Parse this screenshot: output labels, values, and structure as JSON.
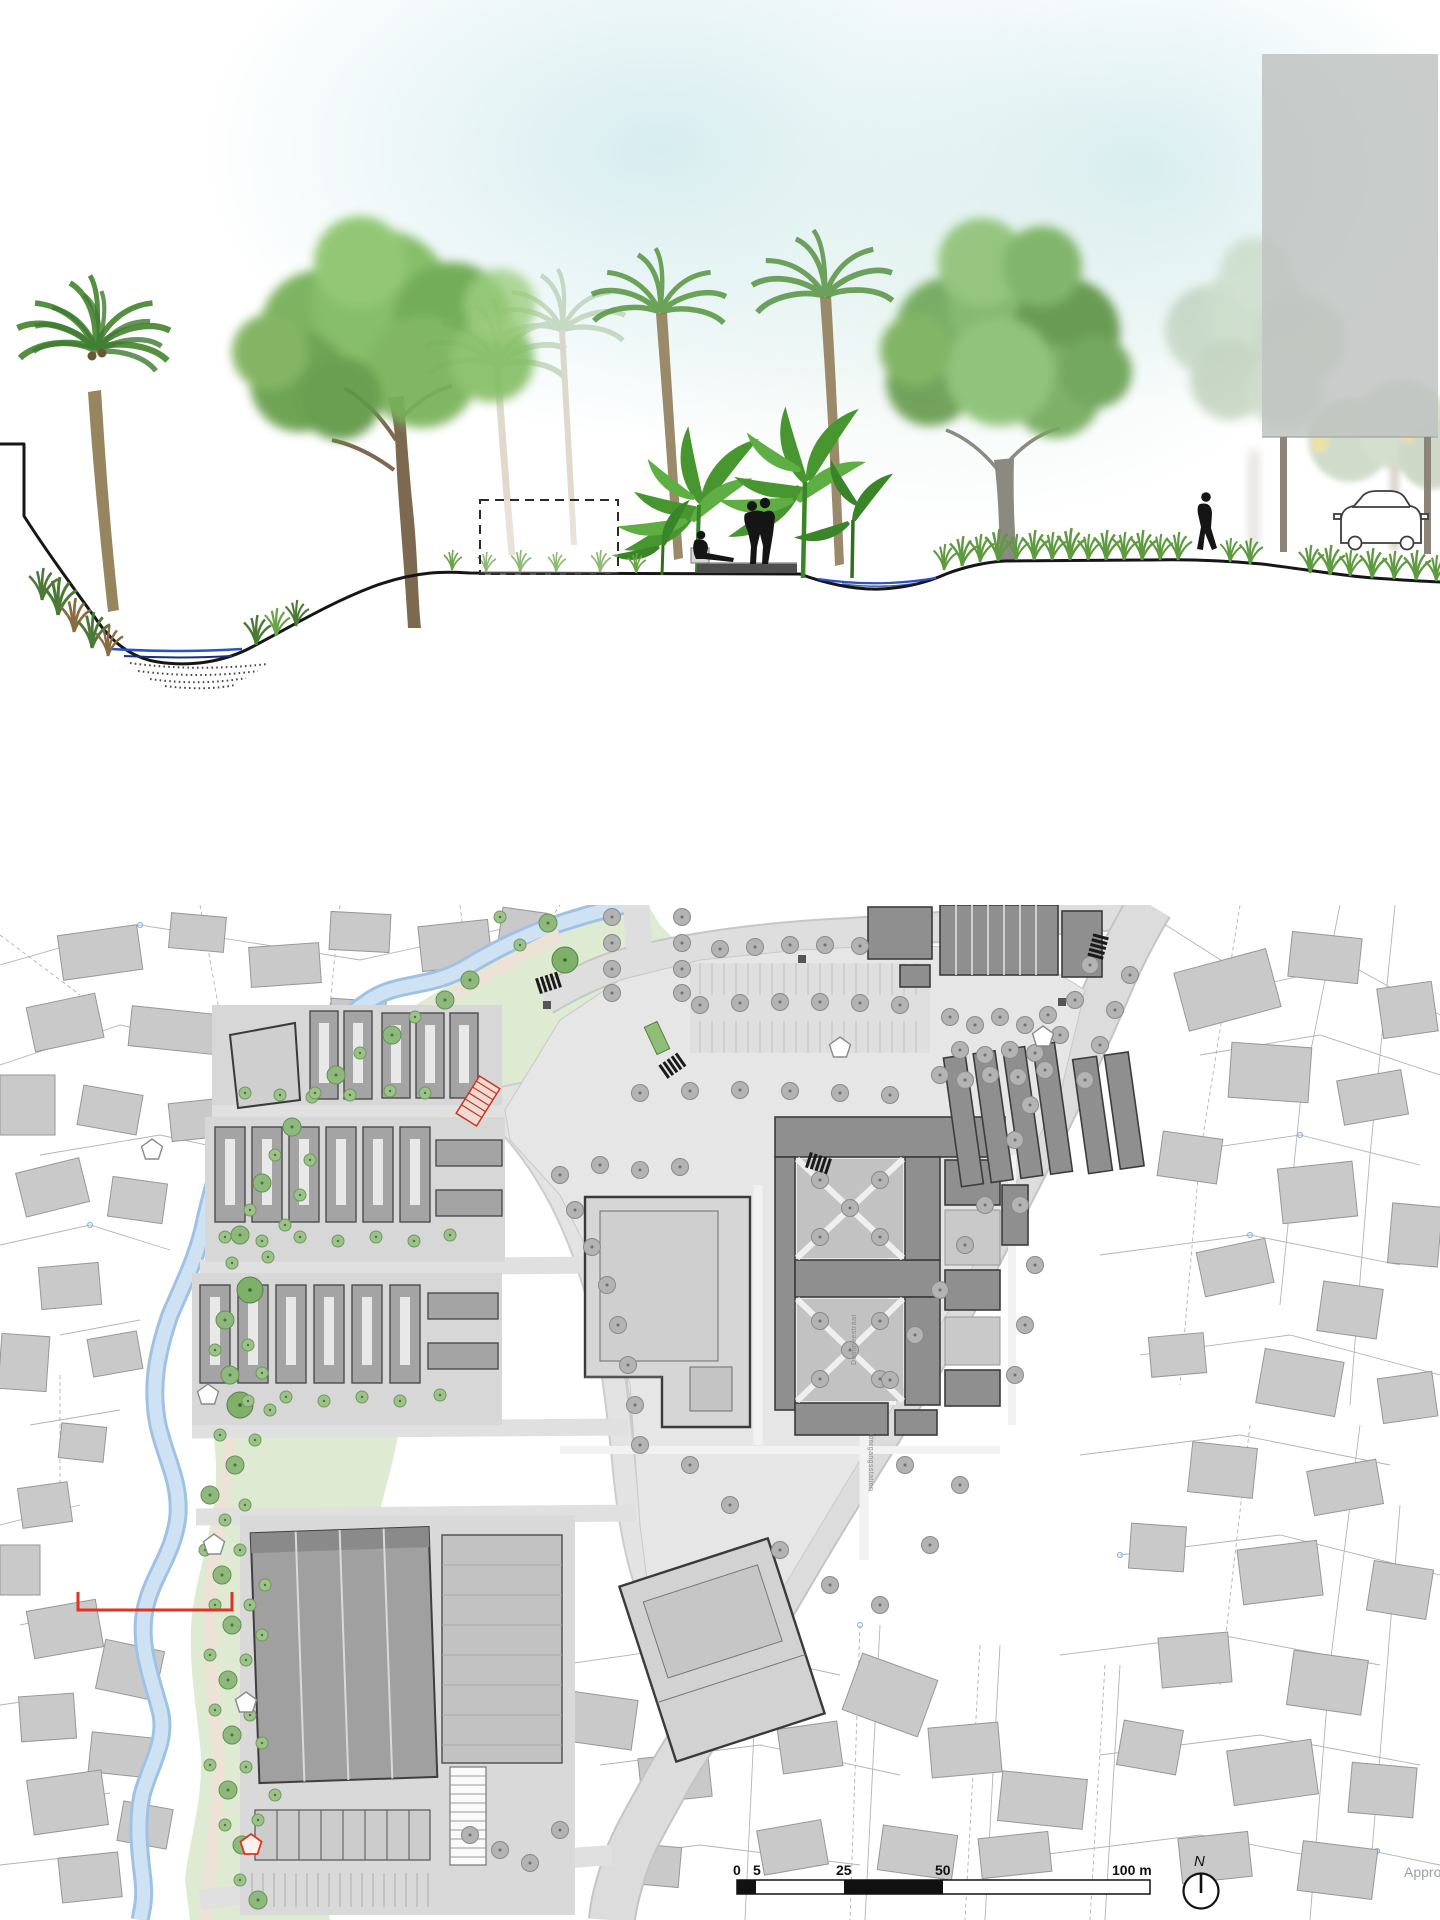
{
  "map": {
    "street_labels": {
      "label_1": "Domineestraat",
      "label_2": "Doorgangsstation"
    },
    "scale_bar": {
      "tick_0": "0",
      "tick_5": "5",
      "tick_25": "25",
      "tick_50": "50",
      "tick_100": "100 m"
    },
    "north_arrow": {
      "label": "N"
    },
    "watermark": "Appro"
  },
  "colors": {
    "water_line": "#2a52c8",
    "river_fill": "#cfe2f4",
    "river_edge": "#9fc2e4",
    "park_green": "#dfead2",
    "tree_green": "#8fb97c",
    "tree_gray": "#b3b3b3",
    "building_dark": "#8f8f8f",
    "building_context": "#c9c9c9",
    "marker_red": "#e03322",
    "massing_block": "#bfc3c1",
    "sky_haze": "#d5ecef"
  }
}
